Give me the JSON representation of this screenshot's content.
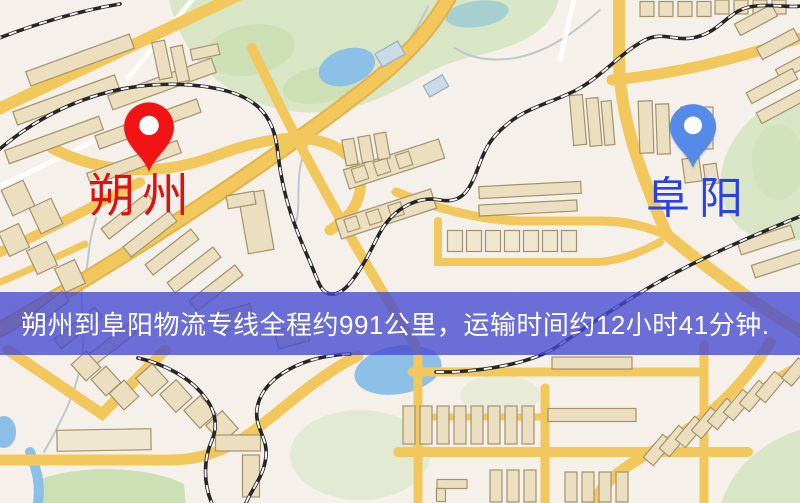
{
  "markers": {
    "origin": {
      "label": "朔州",
      "text_color": "#e11010",
      "pin_color": "#f21414",
      "pin_icon": "map-pin"
    },
    "destination": {
      "label": "阜阳",
      "text_color": "#2a41e8",
      "pin_color": "#568ae8",
      "pin_icon": "map-pin"
    }
  },
  "banner": {
    "text": "朔州到阜阳物流专线全程约991公里，运输时间约12小时41分钟.",
    "background": "rgba(68,73,208,0.78)",
    "text_color": "#ffffff"
  },
  "map_palette": {
    "background": "#f6f0ea",
    "road_major": "#f2c85c",
    "road_casing": "#e2b24c",
    "park": "#d8e6c6",
    "water": "#8cc0e6",
    "railway": "#262626",
    "building_fill": "#ebdfc0",
    "building_stroke": "#a3926d"
  }
}
